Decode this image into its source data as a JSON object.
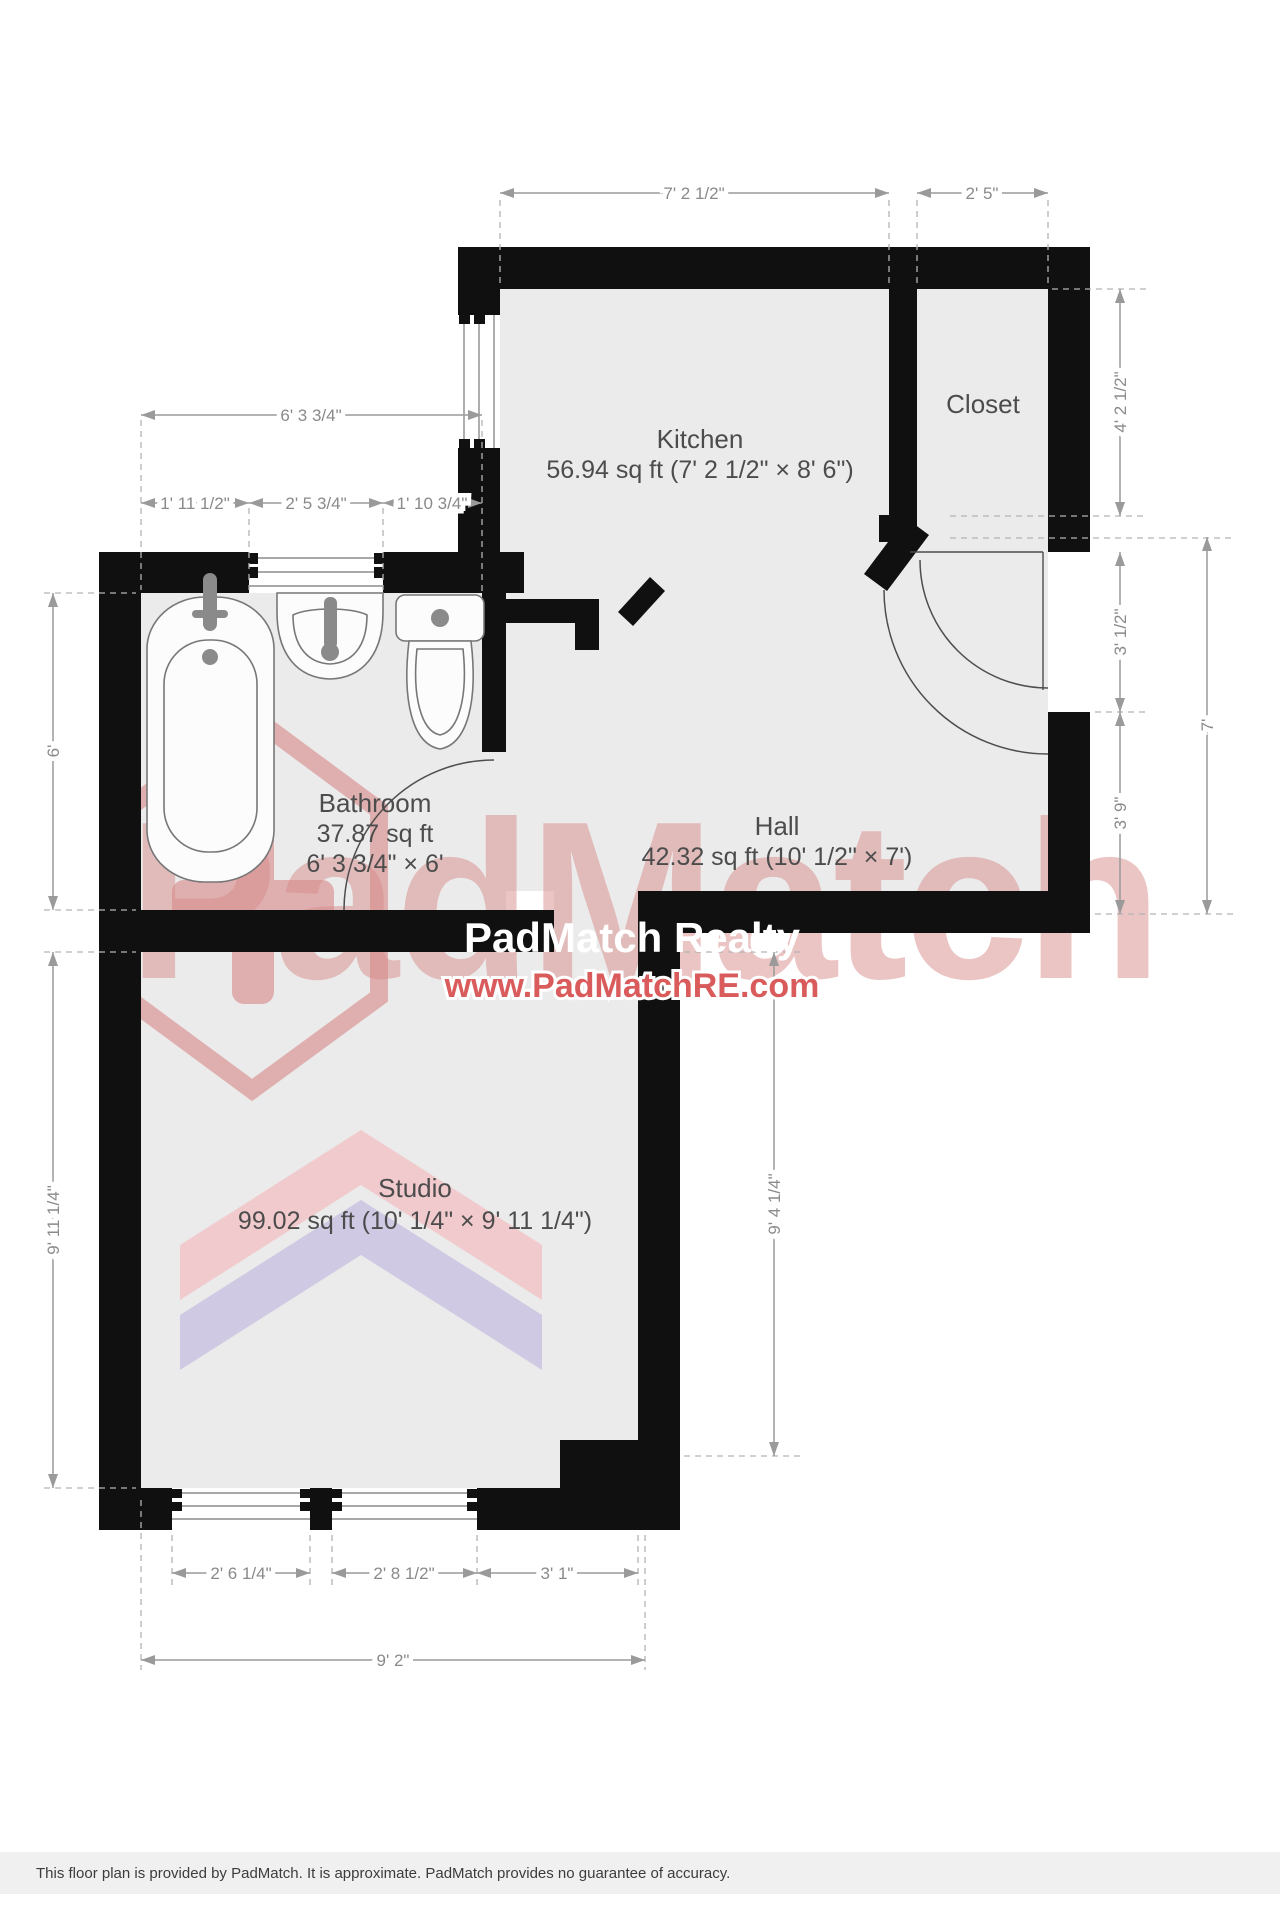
{
  "watermark": {
    "brand": "PadMatch",
    "title": "PadMatch Realty",
    "url": "www.PadMatchRE.com",
    "accent_red": "#c94f4f",
    "pink": "#f2c7ca",
    "purple": "#cdc5e2"
  },
  "rooms": {
    "kitchen": {
      "name": "Kitchen",
      "area": "56.94 sq ft (7' 2 1/2\" × 8' 6\")"
    },
    "closet": {
      "name": "Closet"
    },
    "bathroom": {
      "name": "Bathroom",
      "area": "37.87 sq ft",
      "size": "6' 3 3/4\" × 6'"
    },
    "hall": {
      "name": "Hall",
      "area": "42.32 sq ft (10' 1/2\" × 7')"
    },
    "studio": {
      "name": "Studio",
      "area": "99.02 sq ft (10' 1/4\" × 9' 11 1/4\")"
    }
  },
  "dimensions": {
    "top_kitchen": "7' 2 1/2\"",
    "top_closet": "2' 5\"",
    "bath_top_total": "6' 3 3/4\"",
    "bath_seg1": "1' 11 1/2\"",
    "bath_seg2": "2' 5 3/4\"",
    "bath_seg3": "1' 10 3/4\"",
    "left_bath": "6'",
    "left_studio": "9' 11 1/4\"",
    "right_closet": "4' 2 1/2\"",
    "right_upper": "3' 1/2\"",
    "right_lower": "3' 9\"",
    "right_total": "7'",
    "studio_right": "9' 4 1/4\"",
    "bottom_win1": "2' 6 1/4\"",
    "bottom_win2": "2' 8 1/2\"",
    "bottom_seg3": "3' 1\"",
    "bottom_total": "9' 2\""
  },
  "footer": {
    "disclaimer": "This floor plan is provided by PadMatch. It is approximate. PadMatch provides no guarantee of accuracy."
  }
}
